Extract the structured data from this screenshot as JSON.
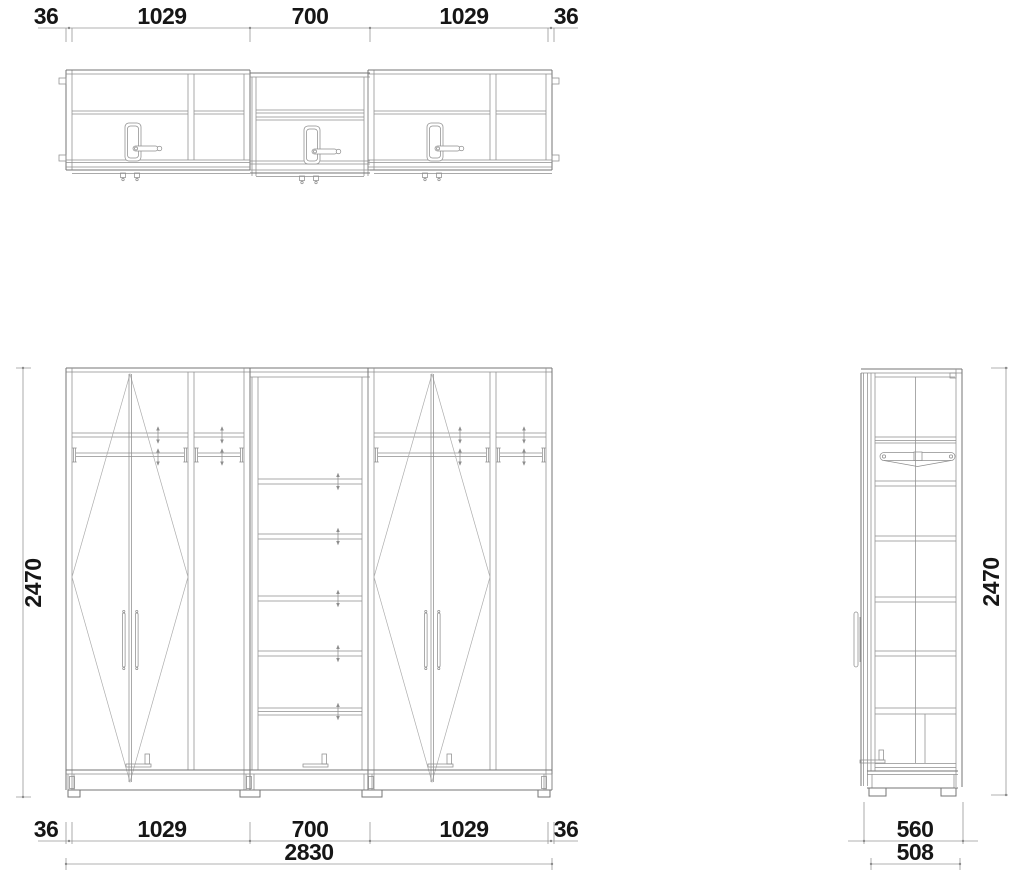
{
  "dims": {
    "top": [
      "36",
      "1029",
      "700",
      "1029",
      "36"
    ],
    "bottom": [
      "36",
      "1029",
      "700",
      "1029",
      "36"
    ],
    "overall_width": "2830",
    "height_left": "2470",
    "height_right": "2470",
    "side_depth_outer": "560",
    "side_depth_inner": "508"
  },
  "colors": {
    "background": "#ffffff",
    "line": "#767676",
    "line_light": "#adadad",
    "dimension_text": "#161616"
  }
}
